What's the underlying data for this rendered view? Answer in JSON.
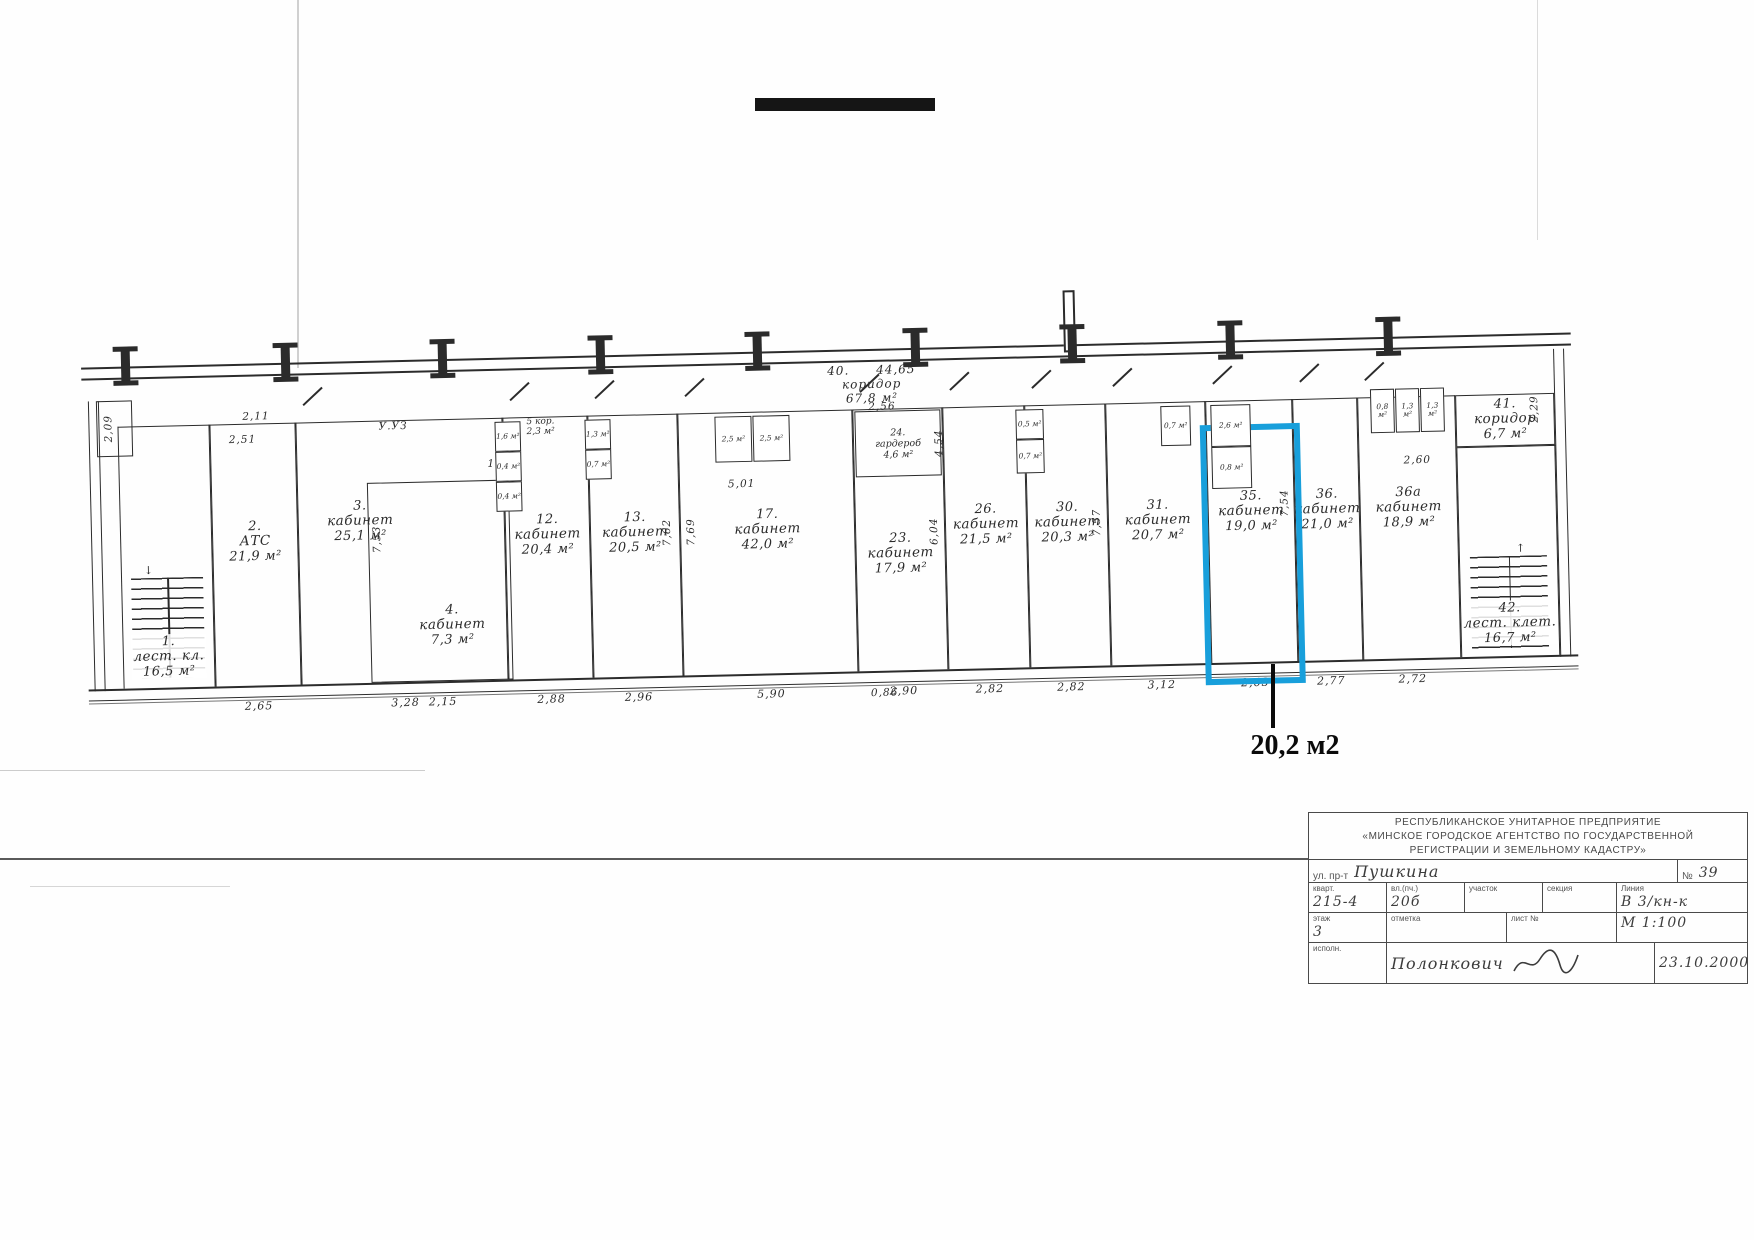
{
  "note": {
    "text": "20,2 м2"
  },
  "plan": {
    "corridor_top": {
      "num": "40.",
      "name": "коридор",
      "area": "67,8 м²",
      "dim": "44,65"
    },
    "corridor5": {
      "num": "5",
      "name": "кор.",
      "area": "2,3 м²"
    },
    "wardrobe": {
      "num": "24.",
      "name": "гардероб",
      "area": "4,6 м²"
    },
    "rooms": [
      {
        "id": "r1",
        "num": "1.",
        "name": "лест. кл.",
        "area": "16,5 м²",
        "dim": ""
      },
      {
        "id": "r2",
        "num": "2.",
        "name": "АТС",
        "area": "21,9 м²",
        "dim": "2,65"
      },
      {
        "id": "r3",
        "num": "3.",
        "name": "кабинет",
        "area": "25,1 м²",
        "dim": "3,28"
      },
      {
        "id": "r4",
        "num": "4.",
        "name": "кабинет",
        "area": "7,3 м²",
        "dim": "2,15"
      },
      {
        "id": "r12",
        "num": "12.",
        "name": "кабинет",
        "area": "20,4 м²",
        "dim": "2,88"
      },
      {
        "id": "r13",
        "num": "13.",
        "name": "кабинет",
        "area": "20,5 м²",
        "dim": "2,96"
      },
      {
        "id": "r17",
        "num": "17.",
        "name": "кабинет",
        "area": "42,0 м²",
        "dim": "5,90"
      },
      {
        "id": "r23",
        "num": "23.",
        "name": "кабинет",
        "area": "17,9 м²",
        "dim": "2,90"
      },
      {
        "id": "r26",
        "num": "26.",
        "name": "кабинет",
        "area": "21,5 м²",
        "dim": "2,82"
      },
      {
        "id": "r30",
        "num": "30.",
        "name": "кабинет",
        "area": "20,3 м²",
        "dim": "2,82"
      },
      {
        "id": "r31",
        "num": "31.",
        "name": "кабинет",
        "area": "20,7 м²",
        "dim": "3,12"
      },
      {
        "id": "r35",
        "num": "35.",
        "name": "кабинет",
        "area": "19,0 м²",
        "dim": "2,63",
        "highlighted": true
      },
      {
        "id": "r36",
        "num": "36.",
        "name": "кабинет",
        "area": "21,0 м²",
        "dim": "2,77"
      },
      {
        "id": "r36a",
        "num": "36а",
        "name": "кабинет",
        "area": "18,9 м²",
        "dim": "2,72"
      },
      {
        "id": "r41",
        "num": "41.",
        "name": "коридор",
        "area": "6,7 м²",
        "dim": ""
      },
      {
        "id": "r42",
        "num": "42.",
        "name": "лест. клет.",
        "area": "16,7 м²",
        "dim": ""
      }
    ],
    "small_rooms": [
      {
        "num": "6",
        "area": "1,6 м²"
      },
      {
        "num": "7",
        "area": "0,4 м²"
      },
      {
        "num": "8",
        "area": "0,4 м²"
      },
      {
        "num": "14",
        "area": "1,3 м²"
      },
      {
        "num": "15",
        "area": "0,7 м²"
      },
      {
        "num": "18",
        "area": "2,5 м²"
      },
      {
        "num": "19",
        "area": "2,5 м²"
      },
      {
        "num": "27",
        "area": "0,5 м²"
      },
      {
        "num": "28",
        "area": "0,7 м²"
      },
      {
        "num": "32",
        "area": "0,7 м²"
      },
      {
        "num": "33",
        "area": "2,6 м²"
      },
      {
        "num": "34",
        "area": "0,8 м²"
      },
      {
        "num": "37",
        "area": "0,8 м²"
      },
      {
        "num": "38",
        "area": "1,3 м²"
      },
      {
        "num": "39",
        "area": "1,3 м²"
      }
    ],
    "dims": [
      "2,09",
      "2,11",
      "2,51",
      "У.УЗ",
      "1,23",
      "2,56",
      "4,54",
      "5,01",
      "0,86",
      "2,89",
      "2,60",
      "2,29",
      "7,53",
      "7,62",
      "7,69",
      "6,04",
      "7,57",
      "7,54"
    ]
  },
  "title_block": {
    "org_line1": "РЕСПУБЛИКАНСКОЕ УНИТАРНОЕ ПРЕДПРИЯТИЕ",
    "org_line2": "«МИНСКОЕ ГОРОДСКОЕ АГЕНТСТВО ПО ГОСУДАРСТВЕННОЙ",
    "org_line3": "РЕГИСТРАЦИИ И ЗЕМЕЛЬНОМУ КАДАСТРУ»",
    "street_label": "ул. пр-т",
    "street_value": "Пушкина",
    "num_label": "№",
    "num_value": "39",
    "cells": [
      {
        "label": "кварт.",
        "value": "215-4"
      },
      {
        "label": "вл.(пч.)",
        "value": "20б"
      },
      {
        "label": "участок",
        "value": ""
      },
      {
        "label": "секция",
        "value": ""
      }
    ],
    "line_label": "Линия",
    "line_value": "В 3/кн-к",
    "floor_label": "этаж",
    "floor_value": "3",
    "mark_label": "отметка",
    "sheet_label": "лист №",
    "scale_value": "М 1:100",
    "executor_label": "исполн.",
    "executor_value": "Полонкович",
    "date_value": "23.10.2000"
  }
}
